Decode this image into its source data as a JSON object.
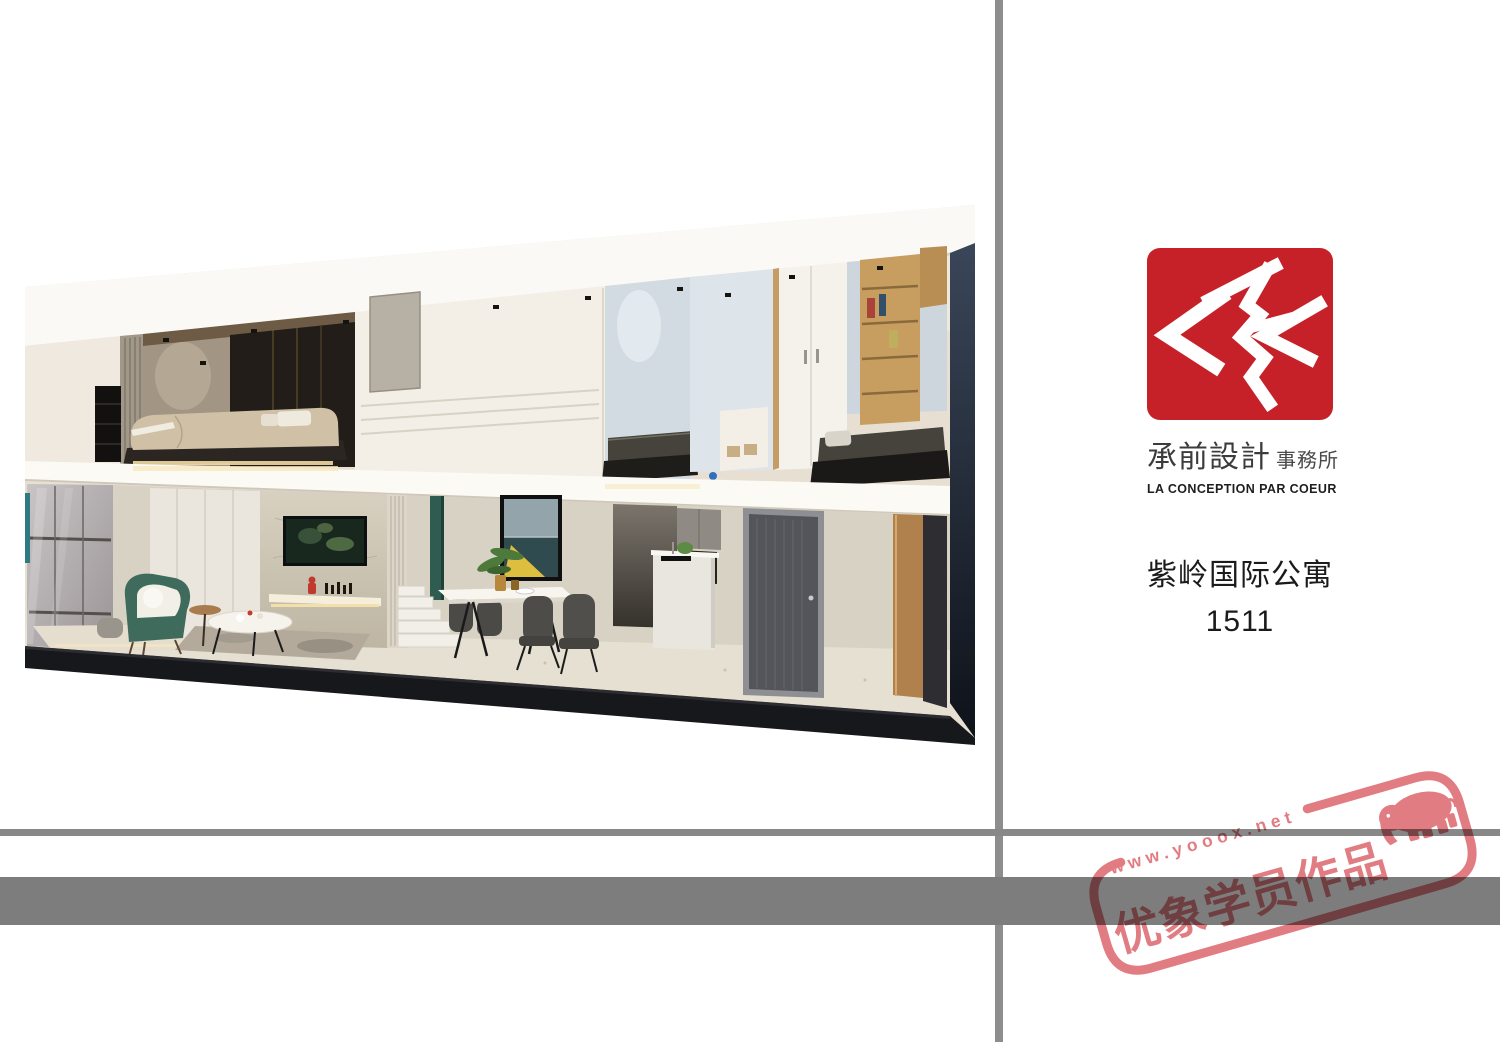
{
  "page": {
    "width": 1500,
    "height": 1042,
    "background": "#ffffff"
  },
  "dividers": {
    "vertical_color": "#8d8d8d",
    "thin_line_color": "#888888",
    "bar_color": "#7d7d7d"
  },
  "brand": {
    "logo_color": "#c62128",
    "logo_glyph": "brush-chevron-seal",
    "name_cn": "承前設計",
    "name_suffix": "事務所",
    "name_en": "LA CONCEPTION PAR COEUR"
  },
  "project": {
    "title": "紫岭国际公寓",
    "unit": "1511"
  },
  "watermark": {
    "url": "www.yooox.net",
    "label": "优象学员作品",
    "icon": "elephant",
    "color": "#df7277"
  },
  "render": {
    "alt": "Perspective cutaway section render of a two-storey loft apartment: upper-level bedrooms with wardrobes and shelving, lower-level living room with TV feature wall, dining table with artwork, kitchen island and dark entry door"
  }
}
